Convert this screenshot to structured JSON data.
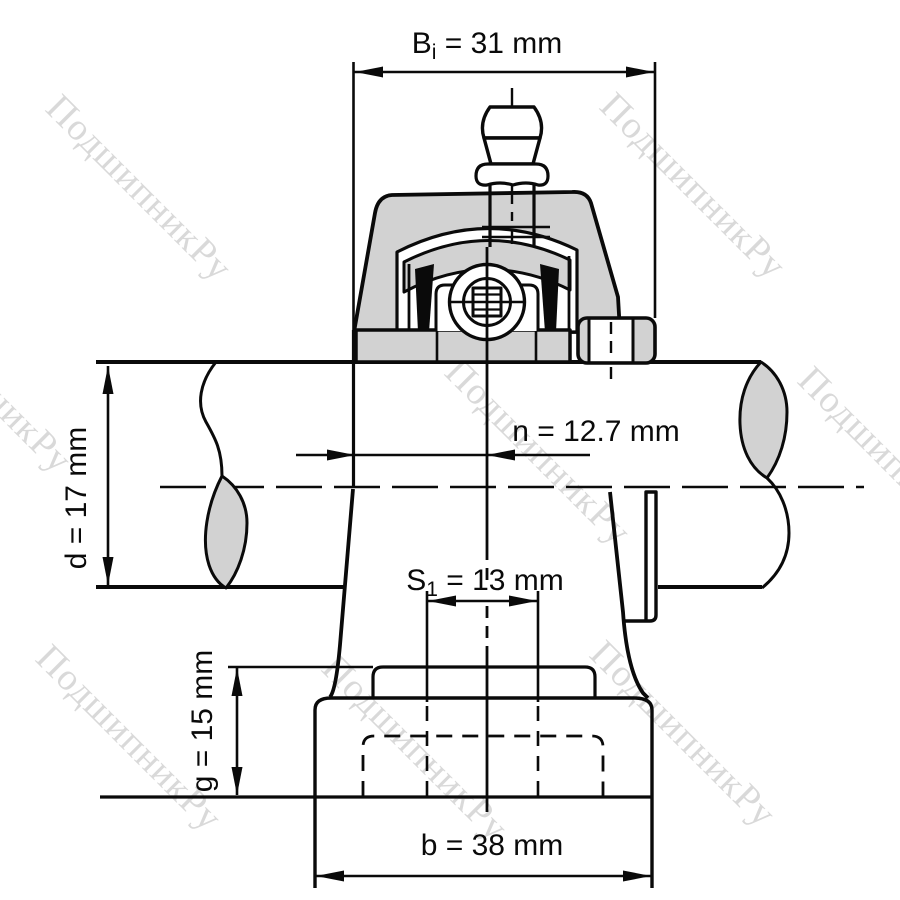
{
  "watermark": {
    "text": "ПодшипникРу",
    "color": "#d9d9d9"
  },
  "drawing": {
    "fill_gray": "#d2d2d2",
    "line_color": "#0a0a0a",
    "background": "#ffffff"
  },
  "dimensions": {
    "bi": {
      "base": "B",
      "sub": "i",
      "rest": " = 31 mm"
    },
    "n": {
      "label": "n = 12.7 mm"
    },
    "d": {
      "label": "d = 17 mm"
    },
    "s1": {
      "base": "S",
      "sub": "1",
      "rest": " = 13 mm"
    },
    "g": {
      "label": "g = 15 mm"
    },
    "b": {
      "label": "b = 38 mm"
    }
  }
}
